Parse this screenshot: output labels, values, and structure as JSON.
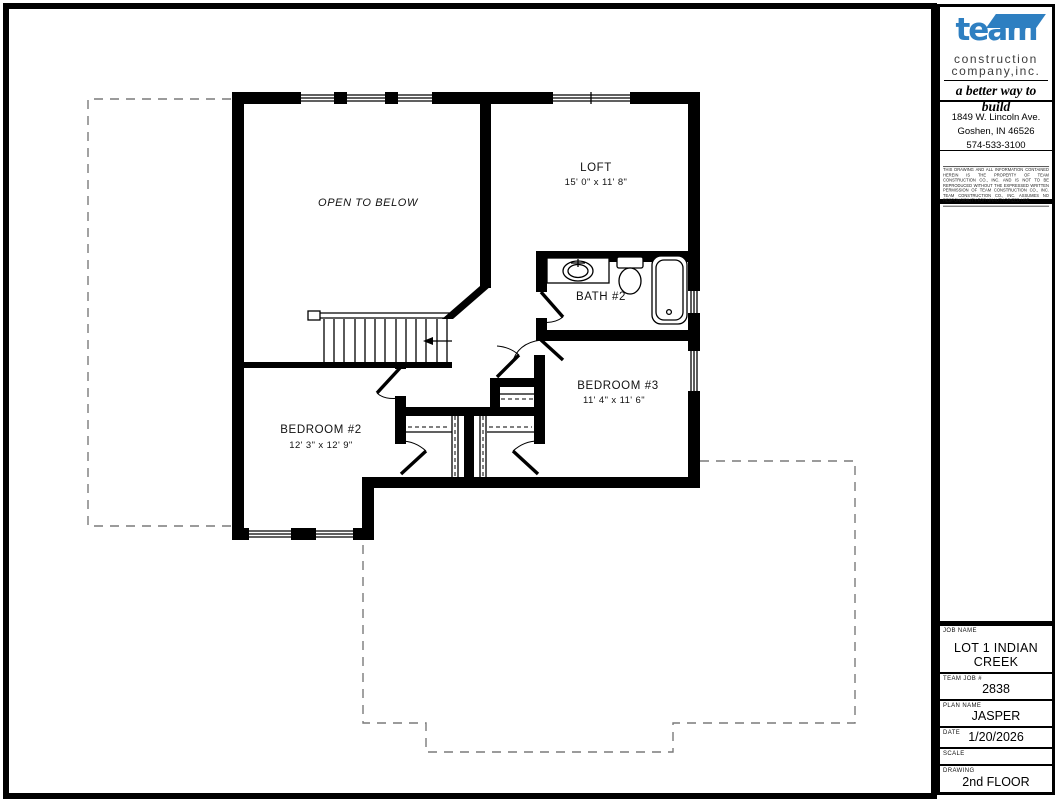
{
  "title_block": {
    "logo": {
      "brand": "team",
      "line1": "construction",
      "line2": "company,inc.",
      "tagline": "a better way to build",
      "brand_color": "#2e7fc1"
    },
    "address": {
      "line1": "1849 W. Lincoln Ave.",
      "line2": "Goshen, IN  46526",
      "phone": "574-533-3100"
    },
    "disclaimer": "THIS DRAWING AND ALL INFORMATION CONTAINED HEREIN IS THE PROPERTY OF TEAM CONSTRUCTION CO., INC. AND IS NOT TO BE REPRODUCED WITHOUT THE EXPRESSED WRITTEN PERMISSION OF TEAM CONSTRUCTION CO., INC. TEAM CONSTRUCTION CO., INC. ASSUMES NO RESPONSIBILITY FOR UNAUTHORIZED USE.",
    "fields": [
      {
        "label": "JOB NAME",
        "value": "LOT 1 INDIAN CREEK"
      },
      {
        "label": "TEAM JOB #",
        "value": "2838"
      },
      {
        "label": "PLAN NAME",
        "value": "JASPER"
      },
      {
        "label": "DATE",
        "value": "1/20/2026"
      },
      {
        "label": "SCALE",
        "value": ""
      },
      {
        "label": "DRAWING",
        "value": "2nd FLOOR"
      }
    ]
  },
  "floor_plan": {
    "rooms": {
      "open_to_below": {
        "label": "OPEN TO BELOW"
      },
      "loft": {
        "label": "LOFT",
        "dims": "15' 0\" x 11' 8\""
      },
      "bath2": {
        "label": "BATH #2"
      },
      "bedroom3": {
        "label": "BEDROOM #3",
        "dims": "11' 4\" x 11' 6\""
      },
      "bedroom2": {
        "label": "BEDROOM #2",
        "dims": "12' 3\" x 12' 9\""
      }
    }
  }
}
